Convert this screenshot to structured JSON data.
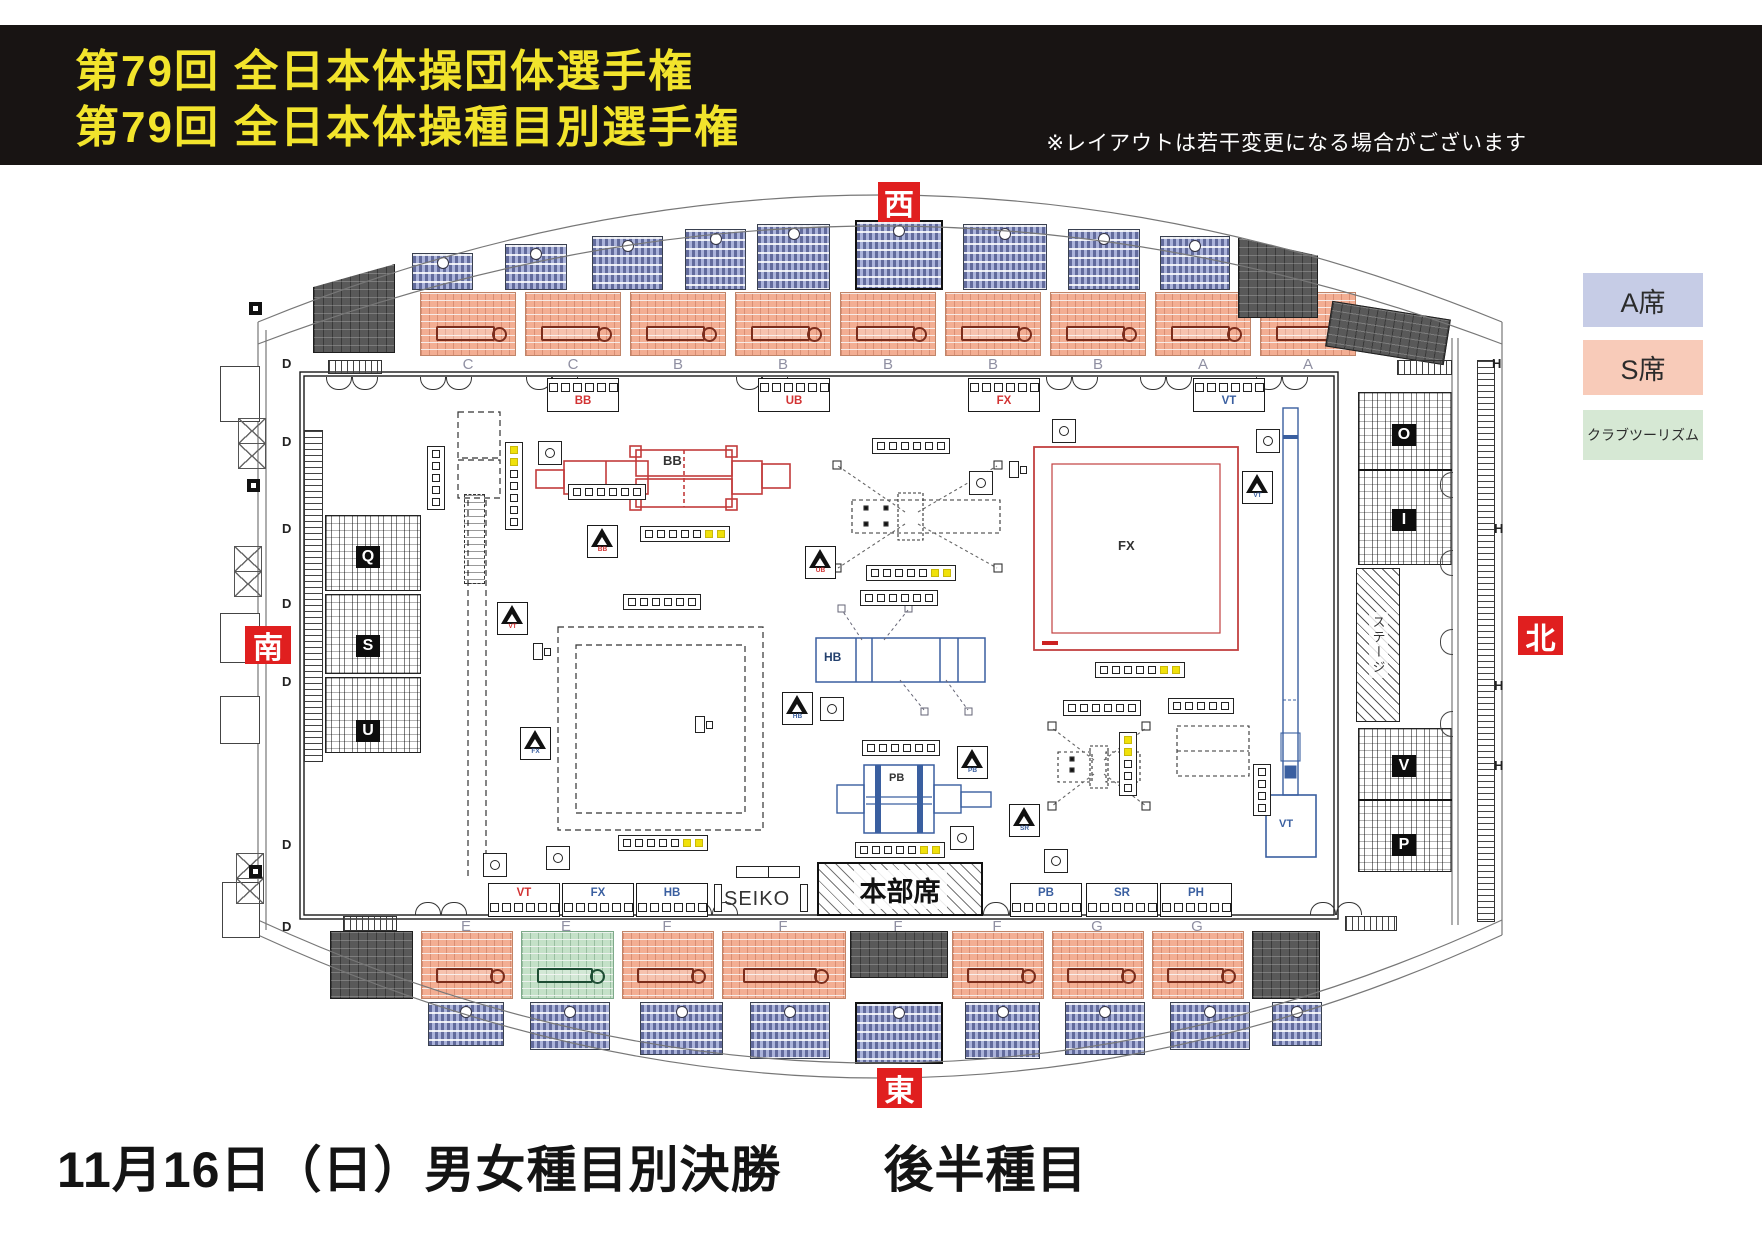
{
  "header": {
    "title_line1": "第79回 全日本体操団体選手権",
    "title_line2": "第79回 全日本体操種目別選手権",
    "note": "※レイアウトは若干変更になる場合がございます"
  },
  "footer": {
    "caption": "11月16日（日）男女種目別決勝　　後半種目"
  },
  "palette": {
    "banner_bg": "#181413",
    "title_yellow": "#f2e42c",
    "direction_red": "#e01f1f",
    "a_seat_blue": "#abb3da",
    "s_seat_salmon": "#f3ae93",
    "club_green": "#c4e1c8",
    "dark_stand": "#595959",
    "women_red": "#c23b3b",
    "men_blue": "#3a5fa0",
    "judge_yellow": "#f0e10a"
  },
  "directions": [
    {
      "label": "西",
      "x": 878,
      "y": 182,
      "w": 42,
      "h": 40
    },
    {
      "label": "南",
      "x": 245,
      "y": 626,
      "w": 46,
      "h": 38
    },
    {
      "label": "北",
      "x": 1518,
      "y": 616,
      "w": 45,
      "h": 39
    },
    {
      "label": "東",
      "x": 877,
      "y": 1068,
      "w": 45,
      "h": 40
    }
  ],
  "legend": [
    {
      "label": "A席",
      "color": "#c6cce6",
      "y": 273,
      "h": 54,
      "font": 27
    },
    {
      "label": "S席",
      "color": "#f8cbb9",
      "y": 340,
      "h": 55,
      "font": 27
    },
    {
      "label": "クラブツーリズム",
      "color": "#d6e8d4",
      "y": 410,
      "h": 50,
      "font": 14
    }
  ],
  "arena": {
    "bands": {
      "top_y": 292,
      "top_h": 64,
      "bottom_y": 931,
      "bottom_h": 68
    },
    "top_blue": [
      {
        "x": 412,
        "y": 253,
        "w": 61,
        "h": 37
      },
      {
        "x": 505,
        "y": 244,
        "w": 62,
        "h": 46
      },
      {
        "x": 592,
        "y": 236,
        "w": 71,
        "h": 54
      },
      {
        "x": 685,
        "y": 229,
        "w": 61,
        "h": 61
      },
      {
        "x": 757,
        "y": 224,
        "w": 73,
        "h": 66
      },
      {
        "x": 855,
        "y": 220,
        "w": 88,
        "h": 70,
        "boxed": true
      },
      {
        "x": 963,
        "y": 224,
        "w": 84,
        "h": 66
      },
      {
        "x": 1068,
        "y": 229,
        "w": 72,
        "h": 61
      },
      {
        "x": 1160,
        "y": 236,
        "w": 70,
        "h": 54
      }
    ],
    "bottom_blue": [
      {
        "x": 428,
        "y": 1002,
        "w": 76,
        "h": 44
      },
      {
        "x": 530,
        "y": 1002,
        "w": 80,
        "h": 48
      },
      {
        "x": 640,
        "y": 1002,
        "w": 83,
        "h": 53
      },
      {
        "x": 750,
        "y": 1002,
        "w": 80,
        "h": 57
      },
      {
        "x": 855,
        "y": 1002,
        "w": 88,
        "h": 62,
        "boxed": true
      },
      {
        "x": 965,
        "y": 1002,
        "w": 75,
        "h": 57
      },
      {
        "x": 1065,
        "y": 1002,
        "w": 80,
        "h": 53
      },
      {
        "x": 1170,
        "y": 1002,
        "w": 80,
        "h": 48
      },
      {
        "x": 1272,
        "y": 1002,
        "w": 50,
        "h": 44
      }
    ],
    "top_sections": [
      {
        "x": 420,
        "w": 96
      },
      {
        "x": 525,
        "w": 96
      },
      {
        "x": 630,
        "w": 96
      },
      {
        "x": 735,
        "w": 96
      },
      {
        "x": 840,
        "w": 96
      },
      {
        "x": 945,
        "w": 96
      },
      {
        "x": 1050,
        "w": 96
      },
      {
        "x": 1155,
        "w": 96
      },
      {
        "x": 1260,
        "w": 96
      }
    ],
    "top_letters": [
      {
        "t": "C",
        "x": 468
      },
      {
        "t": "C",
        "x": 573
      },
      {
        "t": "B",
        "x": 678
      },
      {
        "t": "B",
        "x": 783
      },
      {
        "t": "B",
        "x": 888
      },
      {
        "t": "B",
        "x": 993
      },
      {
        "t": "B",
        "x": 1098
      },
      {
        "t": "A",
        "x": 1203
      },
      {
        "t": "A",
        "x": 1308
      }
    ],
    "bottom_sections": [
      {
        "x": 330,
        "w": 83,
        "type": "dark"
      },
      {
        "x": 421,
        "w": 92,
        "type": "salmon"
      },
      {
        "x": 521,
        "w": 93,
        "type": "green"
      },
      {
        "x": 622,
        "w": 92,
        "type": "salmon"
      },
      {
        "x": 722,
        "w": 124,
        "type": "salmon"
      },
      {
        "x": 850,
        "w": 98,
        "type": "dark",
        "h": 47
      },
      {
        "x": 952,
        "w": 92,
        "type": "salmon"
      },
      {
        "x": 1052,
        "w": 92,
        "type": "salmon"
      },
      {
        "x": 1152,
        "w": 92,
        "type": "salmon"
      },
      {
        "x": 1252,
        "w": 68,
        "type": "dark"
      }
    ],
    "bottom_letters": [
      {
        "t": "E",
        "x": 466
      },
      {
        "t": "E",
        "x": 566
      },
      {
        "t": "F",
        "x": 667
      },
      {
        "t": "F",
        "x": 783
      },
      {
        "t": "F",
        "x": 898
      },
      {
        "t": "F",
        "x": 997
      },
      {
        "t": "G",
        "x": 1097
      },
      {
        "t": "G",
        "x": 1197
      }
    ],
    "dark_blocks": [
      {
        "x": 313,
        "y": 264,
        "w": 82,
        "h": 89,
        "clip": "polygon(0 26%, 100% 0, 100% 100%, 0 100%)"
      },
      {
        "x": 1238,
        "y": 238,
        "w": 80,
        "h": 80,
        "clip": "polygon(0 0, 100% 22%, 100% 100%, 0 100%)"
      },
      {
        "x": 1328,
        "y": 310,
        "w": 120,
        "h": 46,
        "rot": 9
      }
    ],
    "left_stand": [
      {
        "x": 325,
        "y": 515,
        "w": 96,
        "h": 76
      },
      {
        "x": 325,
        "y": 594,
        "w": 96,
        "h": 80
      },
      {
        "x": 325,
        "y": 677,
        "w": 96,
        "h": 76
      }
    ],
    "right_stand": [
      {
        "x": 1358,
        "y": 392,
        "w": 94,
        "h": 173
      },
      {
        "x": 1358,
        "y": 728,
        "w": 94,
        "h": 144
      }
    ],
    "stand_labels": [
      {
        "t": "Q",
        "x": 356,
        "y": 546
      },
      {
        "t": "S",
        "x": 356,
        "y": 635
      },
      {
        "t": "U",
        "x": 356,
        "y": 720
      },
      {
        "t": "O",
        "x": 1392,
        "y": 424
      },
      {
        "t": "I",
        "x": 1392,
        "y": 509
      },
      {
        "t": "V",
        "x": 1392,
        "y": 755
      },
      {
        "t": "P",
        "x": 1392,
        "y": 834
      }
    ],
    "stage": {
      "label": "ステージ"
    },
    "d_letters": [
      356,
      434,
      521,
      596,
      674,
      837,
      919
    ],
    "h_letters": [
      [
        1492,
        356
      ],
      [
        1494,
        521
      ],
      [
        1494,
        678
      ],
      [
        1494,
        758
      ]
    ],
    "xboxes": [
      [
        238,
        418
      ],
      [
        238,
        443
      ],
      [
        234,
        546
      ],
      [
        234,
        571
      ],
      [
        236,
        853
      ],
      [
        236,
        878
      ]
    ],
    "pillars": [
      [
        249,
        302
      ],
      [
        247,
        479
      ],
      [
        247,
        651
      ],
      [
        249,
        865
      ]
    ],
    "protrusions": [
      [
        220,
        366,
        38,
        54
      ],
      [
        220,
        613,
        38,
        48
      ],
      [
        220,
        696,
        38,
        46
      ],
      [
        222,
        882,
        36,
        54
      ]
    ],
    "ladders": [
      {
        "x": 328,
        "y": 360,
        "w": 52,
        "h": 12,
        "v": 0
      },
      {
        "x": 1397,
        "y": 360,
        "w": 53,
        "h": 13,
        "v": 0
      },
      {
        "x": 343,
        "y": 916,
        "w": 52,
        "h": 13,
        "v": 0
      },
      {
        "x": 1345,
        "y": 916,
        "w": 50,
        "h": 13,
        "v": 0
      },
      {
        "x": 304,
        "y": 430,
        "w": 17,
        "h": 330,
        "v": 1
      },
      {
        "x": 1477,
        "y": 360,
        "w": 16,
        "h": 560,
        "v": 1
      }
    ],
    "dashcols": [
      [
        464,
        494,
        19,
        88
      ]
    ],
    "arcs": {
      "down": [
        326,
        352,
        420,
        446,
        526,
        552,
        736,
        762,
        1046,
        1072,
        1140,
        1166,
        1256,
        1282
      ],
      "down_y": 377,
      "up": [
        415,
        441,
        686,
        712,
        983,
        1009,
        1310,
        1336
      ],
      "up_y": 902,
      "left_x": 1440,
      "left": [
        472,
        550,
        629,
        711
      ]
    }
  },
  "floor": {
    "tables_top": [
      {
        "label": "BB",
        "x": 547,
        "color": "#d23333"
      },
      {
        "label": "UB",
        "x": 758,
        "color": "#d23333"
      },
      {
        "label": "FX",
        "x": 968,
        "color": "#d23333"
      },
      {
        "label": "VT",
        "x": 1193,
        "color": "#3a5fa0"
      }
    ],
    "tables_bottom": [
      {
        "label": "VT",
        "x": 488,
        "color": "#d23333"
      },
      {
        "label": "FX",
        "x": 562,
        "color": "#3a5fa0"
      },
      {
        "label": "HB",
        "x": 636,
        "color": "#3a5fa0"
      },
      {
        "label": "PB",
        "x": 1010,
        "color": "#3a5fa0"
      },
      {
        "label": "SR",
        "x": 1086,
        "color": "#3a5fa0"
      },
      {
        "label": "PH",
        "x": 1160,
        "color": "#3a5fa0"
      }
    ],
    "seiko": "SEIKO",
    "hq_label": "本部席",
    "apparatus_labels": {
      "bb": "BB",
      "fx": "FX",
      "hb": "HB",
      "pb": "PB",
      "vt": "VT"
    },
    "triangles": [
      {
        "x": 587,
        "y": 525,
        "t": "BB",
        "c": "#d23333"
      },
      {
        "x": 497,
        "y": 602,
        "t": "VT",
        "c": "#d23333"
      },
      {
        "x": 520,
        "y": 727,
        "t": "FX",
        "c": "#3a5fa0"
      },
      {
        "x": 805,
        "y": 546,
        "t": "UB",
        "c": "#d23333"
      },
      {
        "x": 782,
        "y": 692,
        "t": "HB",
        "c": "#3a5fa0"
      },
      {
        "x": 1242,
        "y": 471,
        "t": "VT",
        "c": "#3a5fa0"
      },
      {
        "x": 957,
        "y": 746,
        "t": "PB",
        "c": "#3a5fa0"
      },
      {
        "x": 1009,
        "y": 804,
        "t": "SR",
        "c": "#3a5fa0"
      }
    ],
    "cameras": [
      [
        538,
        441
      ],
      [
        1052,
        419
      ],
      [
        1256,
        429
      ],
      [
        969,
        471
      ],
      [
        820,
        697
      ],
      [
        950,
        826
      ],
      [
        1044,
        849
      ],
      [
        483,
        853
      ],
      [
        546,
        846
      ]
    ],
    "panels": [
      {
        "x": 568,
        "y": 484,
        "n": 6,
        "ny": 0
      },
      {
        "x": 640,
        "y": 526,
        "n": 5,
        "ny": 2
      },
      {
        "x": 872,
        "y": 438,
        "n": 6,
        "ny": 0
      },
      {
        "x": 866,
        "y": 565,
        "n": 5,
        "ny": 2
      },
      {
        "x": 860,
        "y": 590,
        "n": 6,
        "ny": 0
      },
      {
        "x": 618,
        "y": 835,
        "n": 5,
        "ny": 2
      },
      {
        "x": 855,
        "y": 842,
        "n": 5,
        "ny": 2
      },
      {
        "x": 1095,
        "y": 662,
        "n": 5,
        "ny": 2
      },
      {
        "x": 862,
        "y": 740,
        "n": 6,
        "ny": 0
      },
      {
        "x": 1063,
        "y": 700,
        "n": 6,
        "ny": 0
      },
      {
        "x": 1168,
        "y": 698,
        "n": 5,
        "ny": 0
      },
      {
        "x": 623,
        "y": 594,
        "n": 6,
        "ny": 0
      },
      {
        "x": 427,
        "y": 446,
        "n": 5,
        "ny": 0,
        "v": 1
      },
      {
        "x": 505,
        "y": 442,
        "n": 5,
        "ny": 2,
        "v": 1,
        "yf": 1
      },
      {
        "x": 1253,
        "y": 764,
        "n": 4,
        "ny": 0,
        "v": 1
      },
      {
        "x": 1119,
        "y": 732,
        "n": 3,
        "ny": 2,
        "v": 1,
        "yf": 1
      }
    ],
    "mics": [
      [
        533,
        643
      ],
      [
        1009,
        461
      ],
      [
        695,
        716
      ]
    ]
  }
}
